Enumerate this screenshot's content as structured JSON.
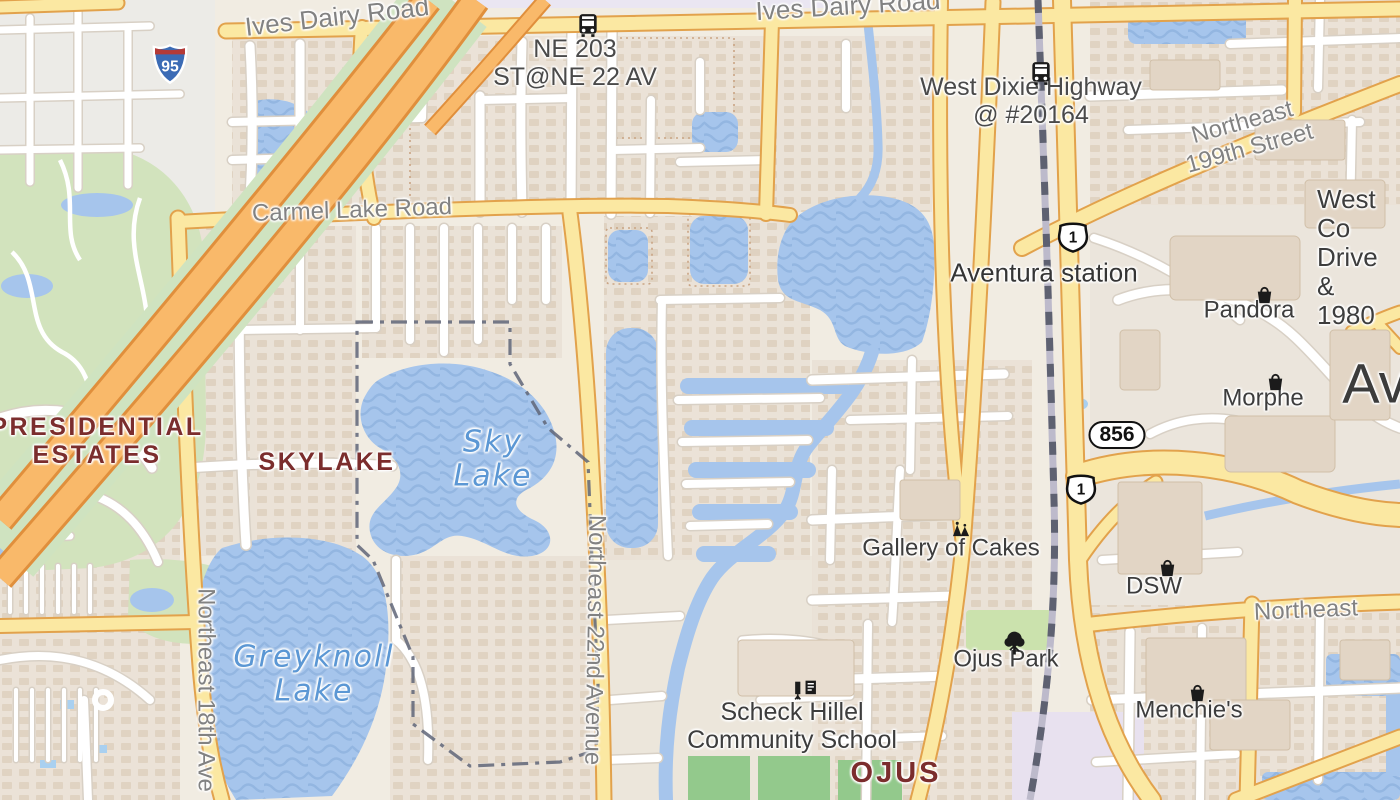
{
  "map_title": "Skylake / Ojus area map",
  "colors": {
    "road_yellow": "#fbe8a2",
    "road_yellow_casing": "#e2a24c",
    "motorway_orange": "#f9b96a",
    "water_blue": "#a6c5ec",
    "water_label_blue": "#5b97d4",
    "neighborhood_maroon": "#7b2d2d",
    "boundary_slate": "#5f6578",
    "park_green": "#d2e3bd",
    "railway_dash": "#5e6171"
  },
  "labels": [
    {
      "name": "road-label-ives-dairy-1",
      "kind": "street",
      "text": "Ives Dairy Road",
      "x": 337,
      "y": 17,
      "rot": -6.5,
      "size": 26
    },
    {
      "name": "road-label-ives-dairy-2",
      "kind": "street",
      "text": "Ives Dairy Road",
      "x": 848,
      "y": 6,
      "rot": -3.5,
      "size": 26
    },
    {
      "name": "busstop-label-ne203",
      "kind": "busstop",
      "text": "NE 203\nST@NE 22 AV",
      "x": 575,
      "y": 63
    },
    {
      "name": "busstop-label-west-dixie",
      "kind": "busstop",
      "text": "West Dixie Highway\n@ #20164",
      "x": 1031,
      "y": 101
    },
    {
      "name": "road-label-ne199",
      "kind": "street",
      "text": "Northeast 199th Street",
      "x": 1246,
      "y": 136,
      "rot": -15.5,
      "size": 24
    },
    {
      "name": "poi-label-west-country-club",
      "kind": "poi",
      "text": "West Co\nDrive &\n1980",
      "x": 1317,
      "y": 258,
      "size": 26,
      "anchor": "left"
    },
    {
      "name": "station-label-aventura",
      "kind": "station",
      "text": "Aventura station",
      "x": 1044,
      "y": 273
    },
    {
      "name": "poi-label-pandora",
      "kind": "poi",
      "text": "Pandora",
      "x": 1249,
      "y": 311
    },
    {
      "name": "poi-label-morphe",
      "kind": "poi",
      "text": "Morphe",
      "x": 1263,
      "y": 399
    },
    {
      "name": "city-label-aventura",
      "kind": "city",
      "text": "Ave",
      "x": 1390,
      "y": 384
    },
    {
      "name": "neighborhood-label-presidential-estates",
      "kind": "neighborhood",
      "text": "PRESIDENTIAL\nESTATES",
      "x": 97,
      "y": 441
    },
    {
      "name": "neighborhood-label-skylake",
      "kind": "neighborhood",
      "text": "SKYLAKE",
      "x": 327,
      "y": 462
    },
    {
      "name": "water-label-sky-lake",
      "kind": "water",
      "text": "Sky\nLake",
      "x": 493,
      "y": 459
    },
    {
      "name": "water-label-greyknoll-lake",
      "kind": "water",
      "text": "Greyknoll\nLake",
      "x": 314,
      "y": 674
    },
    {
      "name": "poi-label-gallery-of-cakes",
      "kind": "poi",
      "text": "Gallery of Cakes",
      "x": 951,
      "y": 549
    },
    {
      "name": "poi-label-dsw",
      "kind": "poi",
      "text": "DSW",
      "x": 1154,
      "y": 587
    },
    {
      "name": "poi-label-ojus-park",
      "kind": "poi",
      "text": "Ojus Park",
      "x": 1006,
      "y": 660
    },
    {
      "name": "poi-label-menchies",
      "kind": "poi",
      "text": "Menchie's",
      "x": 1189,
      "y": 711
    },
    {
      "name": "poi-label-scheck-hillel",
      "kind": "poi",
      "text": "Scheck Hillel\nCommunity School",
      "x": 792,
      "y": 726,
      "size": 25
    },
    {
      "name": "neighborhood-label-ojus",
      "kind": "neighborhood-big",
      "text": "OJUS",
      "x": 896,
      "y": 773
    },
    {
      "name": "road-label-ne-18th-ave",
      "kind": "street",
      "text": "Northeast 18th Ave",
      "x": 205,
      "y": 690,
      "rot": 90,
      "size": 24
    },
    {
      "name": "road-label-ne-22nd-ave",
      "kind": "street",
      "text": "Northeast 22nd Avenue",
      "x": 594,
      "y": 640,
      "rot": 91,
      "size": 24
    },
    {
      "name": "road-label-northeast",
      "kind": "street",
      "text": "Northeast",
      "x": 1306,
      "y": 611,
      "rot": -2.5,
      "size": 24
    },
    {
      "name": "road-label-carmel-lake",
      "kind": "street",
      "text": "Carmel Lake Road",
      "x": 352,
      "y": 211,
      "rot": -2,
      "size": 24
    }
  ],
  "shields": [
    {
      "name": "shield-i95",
      "kind": "interstate",
      "text": "95",
      "x": 152,
      "y": 42
    },
    {
      "name": "shield-us1-north",
      "kind": "us",
      "text": "1",
      "x": 1056,
      "y": 221
    },
    {
      "name": "shield-us1-south",
      "kind": "us",
      "text": "1",
      "x": 1064,
      "y": 473
    },
    {
      "name": "shield-856",
      "kind": "pill",
      "text": "856",
      "x": 1117,
      "y": 435
    }
  ],
  "icons": [
    {
      "name": "bus-icon",
      "glyph": "bus",
      "x": 575,
      "y": 12
    },
    {
      "name": "bus-icon",
      "glyph": "bus",
      "x": 1028,
      "y": 60
    },
    {
      "name": "shop-bag-icon",
      "glyph": "bag",
      "x": 1253,
      "y": 283
    },
    {
      "name": "shop-bag-icon",
      "glyph": "bag",
      "x": 1264,
      "y": 370
    },
    {
      "name": "shop-bag-icon",
      "glyph": "bag",
      "x": 1156,
      "y": 556
    },
    {
      "name": "shop-bag-icon",
      "glyph": "bag",
      "x": 1186,
      "y": 681
    },
    {
      "name": "park-tree-icon",
      "glyph": "tree",
      "x": 1001,
      "y": 630
    },
    {
      "name": "school-icon",
      "glyph": "school",
      "x": 791,
      "y": 678
    },
    {
      "name": "confectionery-icon",
      "glyph": "confectionery",
      "x": 949,
      "y": 520
    }
  ]
}
